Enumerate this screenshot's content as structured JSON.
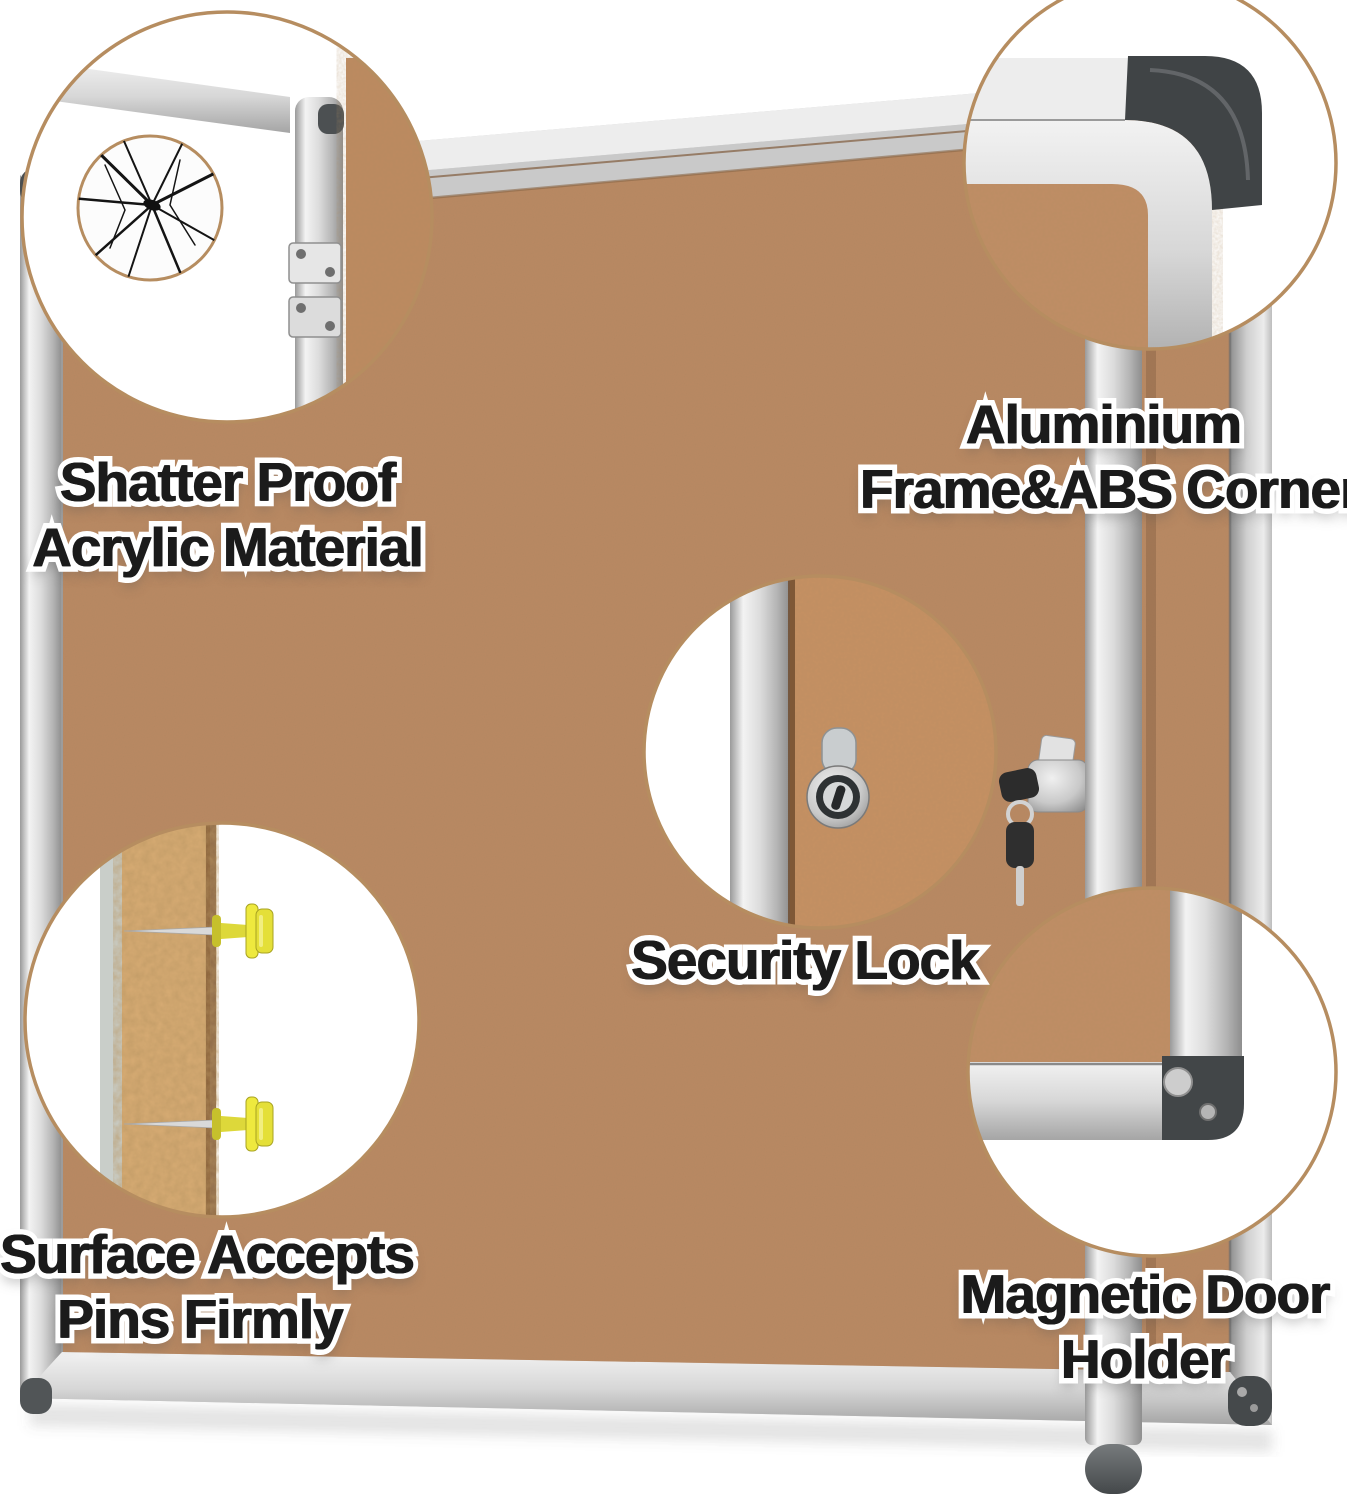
{
  "callouts": {
    "shatter_proof": {
      "lines": [
        "Shatter Proof",
        "Acrylic Material"
      ]
    },
    "aluminium_corners": {
      "lines": [
        "Aluminium",
        "Frame&ABS Corners"
      ]
    },
    "security_lock": {
      "lines": [
        "Security Lock"
      ]
    },
    "pin_surface": {
      "lines": [
        "Surface Accepts",
        "Pins Firmly"
      ]
    },
    "magnetic_holder": {
      "lines": [
        "Magnetic Door",
        "Holder"
      ]
    }
  },
  "colors": {
    "background": "#ffffff",
    "cork": "#c08d65",
    "frame_silver": "#d6d6d6",
    "abs_corner_gray": "#45494b",
    "callout_ring": "#b68d60",
    "pin_yellow": "#ece93e",
    "key_black": "#2c2c2c",
    "label_text": "#1b1b1b",
    "label_outline": "#ffffff"
  }
}
